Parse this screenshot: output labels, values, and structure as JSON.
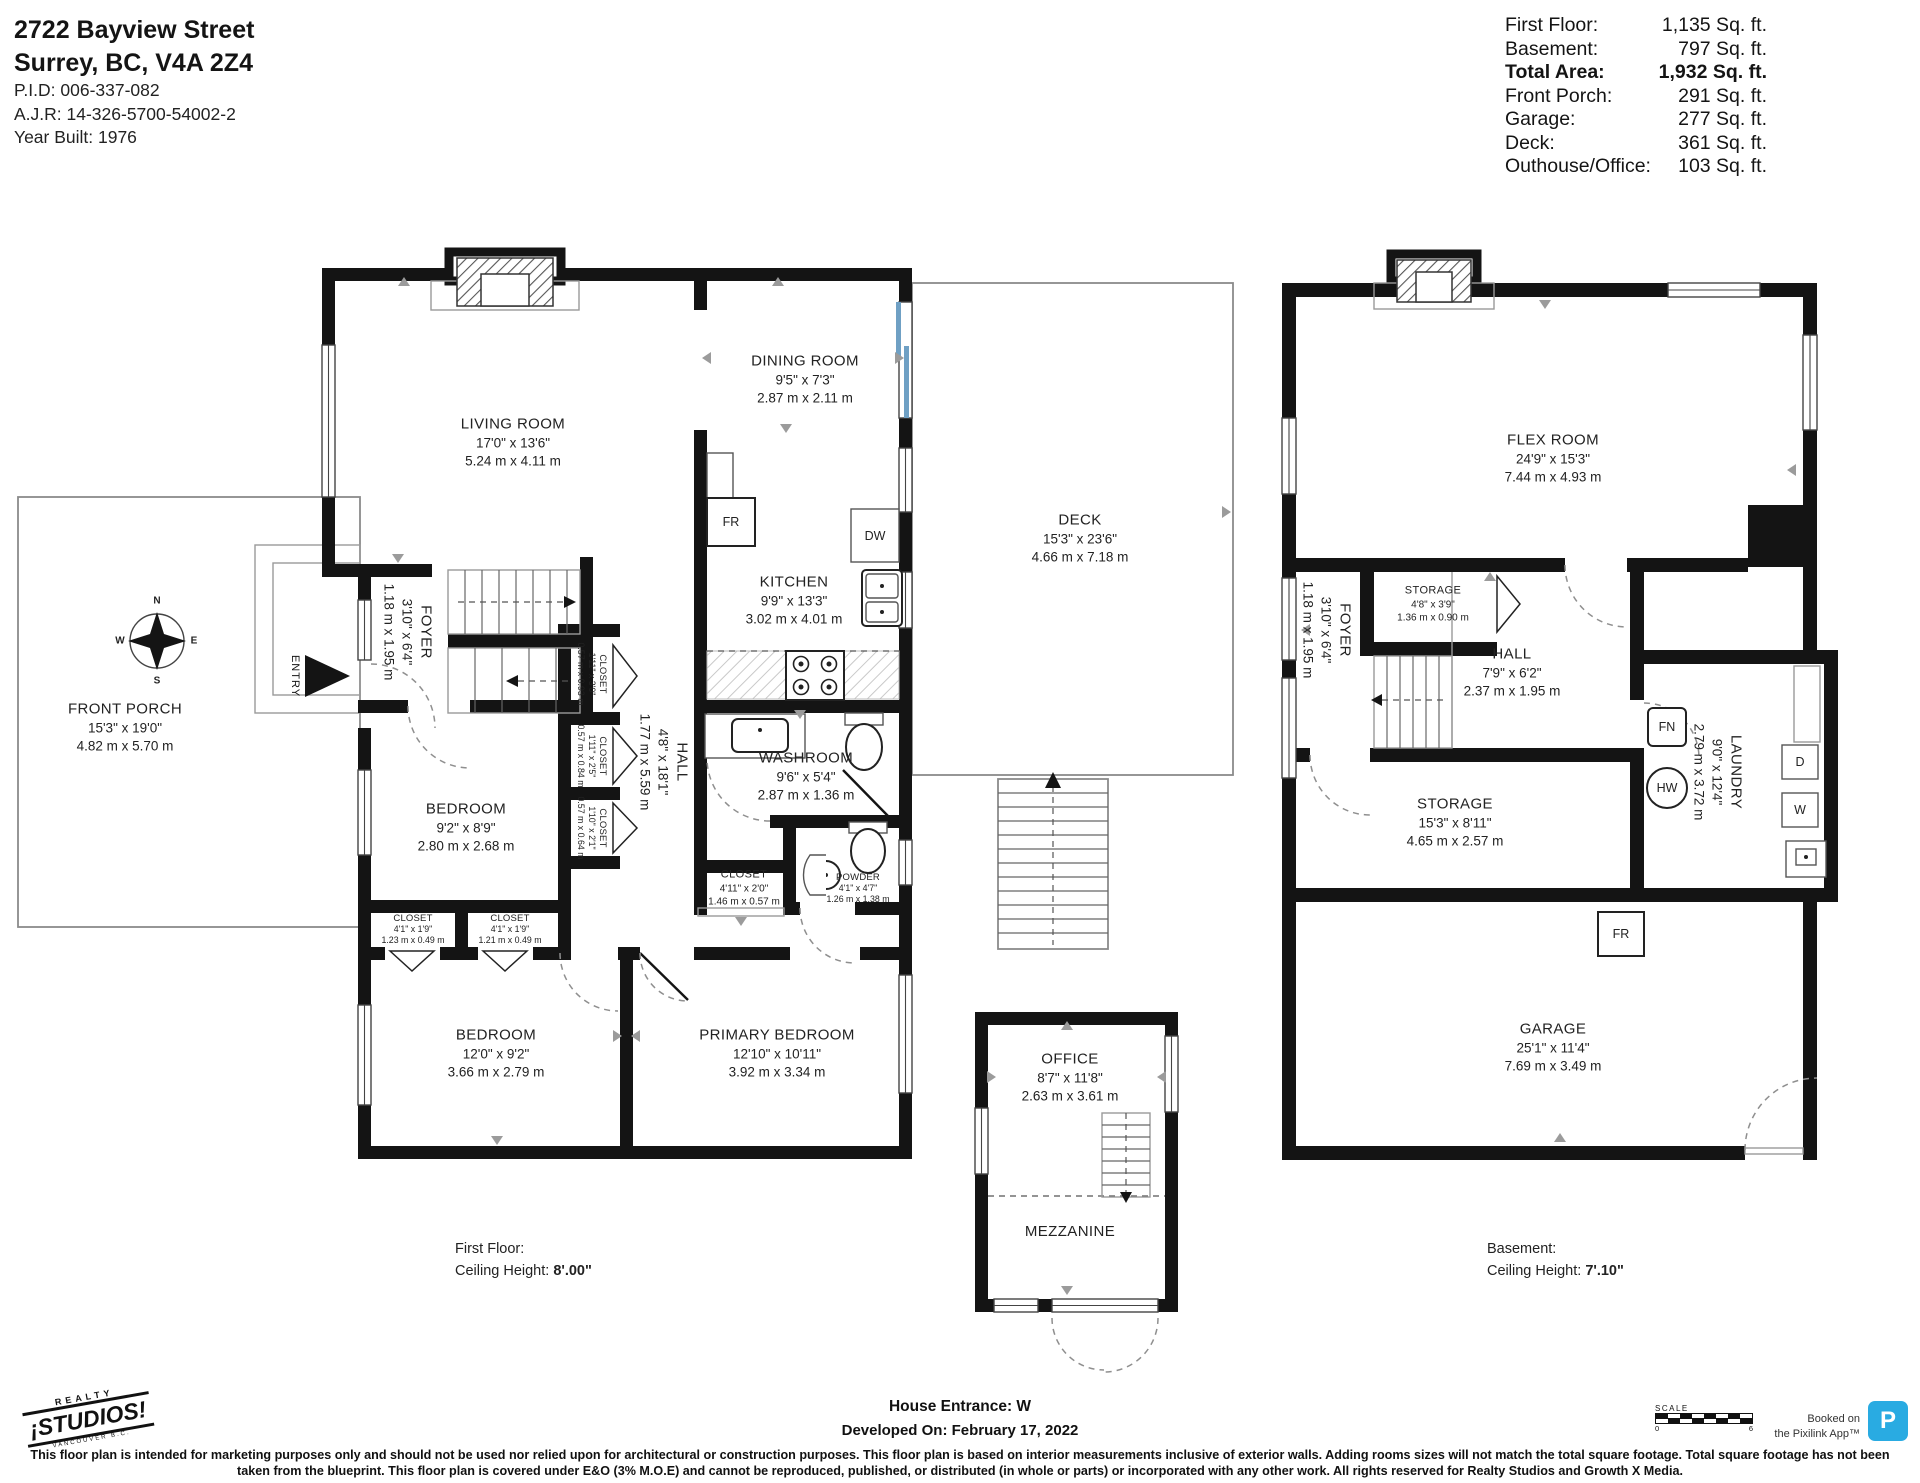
{
  "header": {
    "address_line1": "2722 Bayview Street",
    "address_line2": "Surrey, BC, V4A 2Z4",
    "pid": "P.I.D: 006-337-082",
    "ajr": "A.J.R: 14-326-5700-54002-2",
    "year_built": "Year Built: 1976"
  },
  "area_table": {
    "rows": [
      {
        "label": "First Floor:",
        "value": "1,135 Sq. ft."
      },
      {
        "label": "Basement:",
        "value": "797 Sq. ft."
      },
      {
        "label": "Total Area:",
        "value": "1,932 Sq. ft."
      },
      {
        "label": "Front Porch:",
        "value": "291 Sq. ft."
      },
      {
        "label": "Garage:",
        "value": "277 Sq. ft."
      },
      {
        "label": "Deck:",
        "value": "361 Sq. ft."
      },
      {
        "label": "Outhouse/Office:",
        "value": "103 Sq. ft."
      }
    ]
  },
  "first_floor": {
    "rooms": {
      "living": {
        "name": "LIVING ROOM",
        "imp": "17'0\" x 13'6\"",
        "met": "5.24 m x 4.11 m"
      },
      "dining": {
        "name": "DINING ROOM",
        "imp": "9'5\" x 7'3\"",
        "met": "2.87 m x 2.11 m"
      },
      "kitchen": {
        "name": "KITCHEN",
        "imp": "9'9\" x 13'3\"",
        "met": "3.02 m x 4.01 m"
      },
      "foyer": {
        "name": "FOYER",
        "imp": "3'10\" x 6'4\"",
        "met": "1.18 m x 1.95 m"
      },
      "hall": {
        "name": "HALL",
        "imp": "4'8\" x 18'1\"",
        "met": "1.77 m x 5.59 m"
      },
      "washroom": {
        "name": "WASHROOM",
        "imp": "9'6\" x 5'4\"",
        "met": "2.87 m x 1.36 m"
      },
      "closet_a": {
        "name": "CLOSET",
        "imp": "1'11\" x 3'0\"",
        "met": "0.57 m x 0.93 m"
      },
      "closet_b": {
        "name": "CLOSET",
        "imp": "1'11\" x 2'5\"",
        "met": "0.57 m x 0.84 m"
      },
      "closet_c": {
        "name": "CLOSET",
        "imp": "1'10\" x 2'1\"",
        "met": "0.57 m x 0.64 m"
      },
      "closet_d": {
        "name": "CLOSET",
        "imp": "4'11\" x 2'0\"",
        "met": "1.46 m x 0.57 m"
      },
      "powder": {
        "name": "POWDER",
        "imp": "4'1\" x 4'7\"",
        "met": "1.26 m x 1.38 m"
      },
      "bedroom1": {
        "name": "BEDROOM",
        "imp": "9'2\" x 8'9\"",
        "met": "2.80 m x 2.68 m"
      },
      "closet_e": {
        "name": "CLOSET",
        "imp": "4'1\" x 1'9\"",
        "met": "1.23 m x 0.49 m"
      },
      "closet_f": {
        "name": "CLOSET",
        "imp": "4'1\" x 1'9\"",
        "met": "1.21 m x 0.49 m"
      },
      "bedroom2": {
        "name": "BEDROOM",
        "imp": "12'0\" x 9'2\"",
        "met": "3.66 m x 2.79 m"
      },
      "primary": {
        "name": "PRIMARY BEDROOM",
        "imp": "12'10\" x 10'11\"",
        "met": "3.92 m x 3.34 m"
      }
    },
    "entry_label": "ENTRY",
    "fixtures": {
      "fr": "FR",
      "dw": "DW"
    },
    "note": {
      "line1": "First Floor:",
      "ceiling_label": "Ceiling Height: ",
      "ceiling_value": "8'.00\""
    }
  },
  "basement": {
    "rooms": {
      "flex": {
        "name": "FLEX ROOM",
        "imp": "24'9\" x 15'3\"",
        "met": "7.44 m x 4.93 m"
      },
      "storage1": {
        "name": "STORAGE",
        "imp": "4'8\" x 3'9\"",
        "met": "1.36 m x 0.90 m"
      },
      "foyer": {
        "name": "FOYER",
        "imp": "3'10\" x 6'4\"",
        "met": "1.18 m x 1.95 m"
      },
      "hall": {
        "name": "HALL",
        "imp": "7'9\" x 6'2\"",
        "met": "2.37 m x 1.95 m"
      },
      "laundry": {
        "name": "LAUNDRY",
        "imp": "9'0\" x 12'4\"",
        "met": "2.79 m x 3.72 m"
      },
      "storage2": {
        "name": "STORAGE",
        "imp": "15'3\" x 8'11\"",
        "met": "4.65 m x 2.57 m"
      },
      "garage": {
        "name": "GARAGE",
        "imp": "25'1\" x 11'4\"",
        "met": "7.69 m x 3.49 m"
      }
    },
    "fixtures": {
      "fr": "FR",
      "fn": "FN",
      "hw": "HW",
      "d": "D",
      "w": "W"
    },
    "note": {
      "line1": "Basement:",
      "ceiling_label": "Ceiling Height: ",
      "ceiling_value": "7'.10\""
    }
  },
  "outbuilding": {
    "office": {
      "name": "OFFICE",
      "imp": "8'7\" x 11'8\"",
      "met": "2.63 m x 3.61 m"
    },
    "mezzanine": {
      "name": "MEZZANINE"
    }
  },
  "outdoor": {
    "deck": {
      "name": "DECK",
      "imp": "15'3\" x 23'6\"",
      "met": "4.66 m x 7.18 m"
    },
    "front_porch": {
      "name": "FRONT PORCH",
      "imp": "15'3\" x 19'0\"",
      "met": "4.82 m x 5.70 m"
    }
  },
  "compass": {
    "n": "N",
    "e": "E",
    "s": "S",
    "w": "W"
  },
  "footer": {
    "house_entrance_label": "House Entrance: ",
    "house_entrance_value": "W",
    "developed": "Developed On: February 17, 2022",
    "disclaimer": "This floor plan is intended for marketing purposes only and should not be used nor relied upon for architectural or construction purposes. This floor plan is based on interior measurements inclusive of exterior walls. Adding rooms sizes will not match the total square footage. Total square footage has not been taken from the blueprint. This floor plan is covered under E&O (3% M.O.E) and cannot be reproduced, published, or distributed (in whole or parts) or incorporated with any other work. All rights reserved for Realty Studios and Growth X Media.",
    "logo": {
      "top": "REALTY",
      "main": "¡STUDIOS!",
      "sub": "VANCOUVER B.C."
    },
    "scale": {
      "label": "SCALE",
      "start": "0",
      "end": "6"
    },
    "booked": {
      "line1": "Booked on",
      "line2": "the Pixilink App™",
      "badge": "P"
    }
  },
  "colors": {
    "pixilink_blue": "#29ABE2",
    "slider_blue": "#6FA0C4",
    "wall_black": "#141414"
  }
}
